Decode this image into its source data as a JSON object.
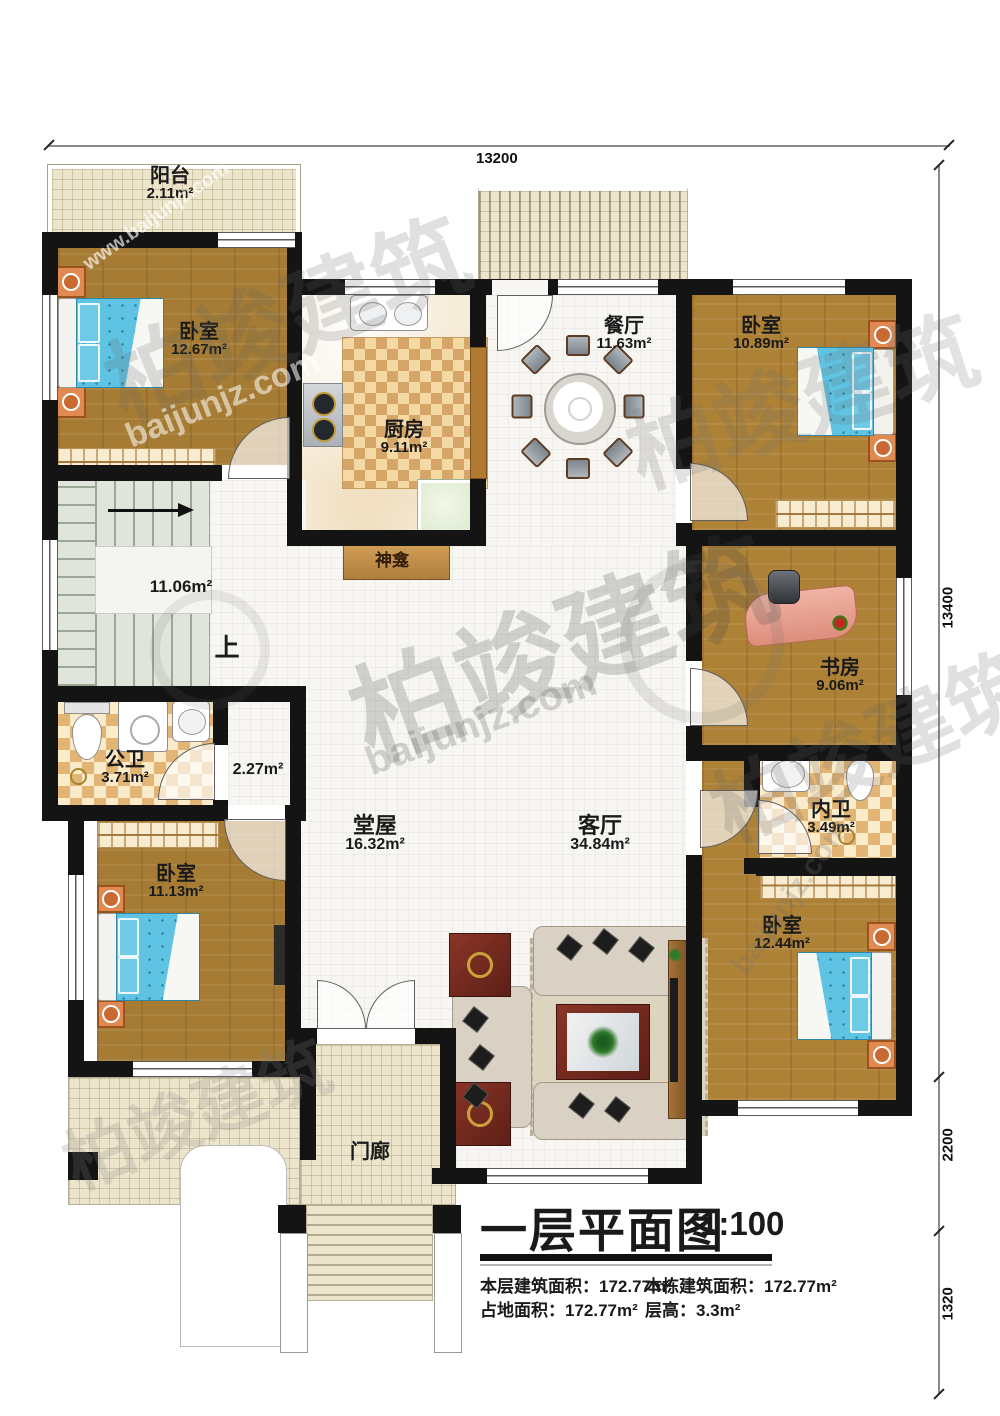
{
  "dimensions": {
    "top": "13200",
    "right_main": "13400",
    "right_mid": "2200",
    "right_low": "1320"
  },
  "title": {
    "main": "一层平面图",
    "scale": "1:100"
  },
  "stats": {
    "r1c1": "本层建筑面积：172.77m²",
    "r1c2": "本栋建筑面积：172.77m²",
    "r2c1": "占地面积：172.77m²",
    "r2c2": "层高：3.3m²"
  },
  "watermark": {
    "brand": "柏竣建筑",
    "site": "baijunjz.com",
    "url": "www.baijunjz.com"
  },
  "rooms": {
    "balcony": {
      "name": "阳台",
      "area": "2.11m²"
    },
    "bedroom_tl": {
      "name": "卧室",
      "area": "12.67m²"
    },
    "kitchen": {
      "name": "厨房",
      "area": "9.11m²"
    },
    "dining": {
      "name": "餐厅",
      "area": "11.63m²"
    },
    "bedroom_tr": {
      "name": "卧室",
      "area": "10.89m²"
    },
    "stairs": {
      "area": "11.06m²",
      "up": "上"
    },
    "shrine": {
      "name": "神龛"
    },
    "study": {
      "name": "书房",
      "area": "9.06m²"
    },
    "bath_public": {
      "name": "公卫",
      "area": "3.71m²"
    },
    "hallway": {
      "area": "2.27m²"
    },
    "bath_private": {
      "name": "内卫",
      "area": "3.49m²"
    },
    "main_hall": {
      "name": "堂屋",
      "area": "16.32m²"
    },
    "living": {
      "name": "客厅",
      "area": "34.84m²"
    },
    "bedroom_bl": {
      "name": "卧室",
      "area": "11.13m²"
    },
    "bedroom_br": {
      "name": "卧室",
      "area": "12.44m²"
    },
    "porch": {
      "name": "门廊"
    }
  }
}
